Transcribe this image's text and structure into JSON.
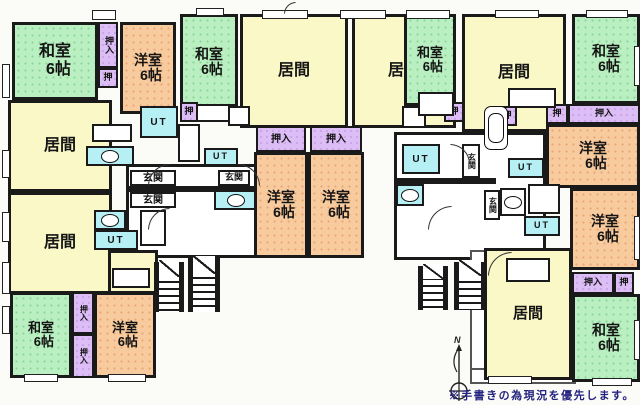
{
  "note": "※手書きの為現況を優先します。",
  "compass_label": "N",
  "colors": {
    "washitsu_green": "#b9efc1",
    "yoshitsu_orange": "#f7cb9e",
    "ima_yellow": "#faf8c6",
    "closet_purple": "#ddbdf5",
    "wet_cyan": "#b6f0f4",
    "wall_black": "#1a1a1a",
    "note_navy": "#23237f"
  },
  "floorplan": {
    "halls": [
      {
        "n": "hallway-left",
        "c": "hall",
        "x": 126,
        "y": 164,
        "w": 134,
        "h": 94
      },
      {
        "n": "hallway-right",
        "c": "hall",
        "x": 394,
        "y": 132,
        "w": 152,
        "h": 128
      },
      {
        "n": "balcony-bottom-right-side",
        "c": "balcony",
        "x": 470,
        "y": 250,
        "w": 16,
        "h": 132
      },
      {
        "n": "balcony-bottom-right-front",
        "c": "balcony",
        "x": 470,
        "y": 368,
        "w": 106,
        "h": 16
      }
    ],
    "walls": [
      {
        "x": 126,
        "y": 186,
        "w": 134,
        "h": 6
      },
      {
        "x": 394,
        "y": 178,
        "w": 102,
        "h": 6
      }
    ],
    "rooms": [
      {
        "n": "washitsu-top-left",
        "t": "和室",
        "s": "6帖",
        "c": "washitsu",
        "x": 12,
        "y": 22,
        "w": 86,
        "h": 78,
        "fs": 16
      },
      {
        "n": "oshiire-top-left",
        "t": "押入",
        "c": "closet",
        "x": 98,
        "y": 22,
        "w": 20,
        "h": 46,
        "fs": 9,
        "v": true
      },
      {
        "n": "oshi-top-left",
        "t": "押",
        "c": "closet",
        "x": 98,
        "y": 68,
        "w": 20,
        "h": 20,
        "fs": 9
      },
      {
        "n": "yoshitsu-top-left",
        "t": "洋室",
        "s": "6帖",
        "c": "yoshitsu",
        "x": 120,
        "y": 22,
        "w": 56,
        "h": 92,
        "fs": 14
      },
      {
        "n": "washitsu-unit-b",
        "t": "和室",
        "s": "6帖",
        "c": "washitsu",
        "x": 180,
        "y": 14,
        "w": 58,
        "h": 96,
        "fs": 14
      },
      {
        "n": "ima-left-upper",
        "t": "居間",
        "c": "ima",
        "x": 8,
        "y": 100,
        "w": 104,
        "h": 92,
        "fs": 16
      },
      {
        "n": "ima-left-lower",
        "t": "居間",
        "c": "ima",
        "x": 8,
        "y": 192,
        "w": 104,
        "h": 102,
        "fs": 16
      },
      {
        "n": "ima-left-lower-ext",
        "t": "",
        "c": "ima",
        "x": 108,
        "y": 250,
        "w": 50,
        "h": 44
      },
      {
        "n": "ut-unit-a",
        "t": "UT",
        "c": "wet",
        "x": 140,
        "y": 106,
        "w": 38,
        "h": 32,
        "fs": 10
      },
      {
        "n": "oshi-unit-a",
        "t": "押",
        "c": "closet",
        "x": 180,
        "y": 102,
        "w": 18,
        "h": 20,
        "fs": 9
      },
      {
        "n": "toilet-unit-a",
        "t": "",
        "c": "wet toilet",
        "x": 86,
        "y": 146,
        "w": 48,
        "h": 20
      },
      {
        "n": "genkan-unit-a",
        "t": "玄関",
        "c": "plain",
        "x": 130,
        "y": 170,
        "w": 46,
        "h": 16,
        "fs": 10
      },
      {
        "n": "genkan-unit-f",
        "t": "玄関",
        "c": "plain",
        "x": 130,
        "y": 192,
        "w": 46,
        "h": 16,
        "fs": 10
      },
      {
        "n": "ut-unit-b",
        "t": "UT",
        "c": "wet",
        "x": 204,
        "y": 148,
        "w": 34,
        "h": 18,
        "fs": 9
      },
      {
        "n": "genkan-unit-b",
        "t": "玄関",
        "c": "plain",
        "x": 218,
        "y": 170,
        "w": 32,
        "h": 16,
        "fs": 9
      },
      {
        "n": "toilet-unit-b",
        "t": "",
        "c": "wet toilet",
        "x": 214,
        "y": 190,
        "w": 44,
        "h": 20
      },
      {
        "n": "toilet-unit-f",
        "t": "",
        "c": "wet toilet",
        "x": 94,
        "y": 210,
        "w": 32,
        "h": 20
      },
      {
        "n": "ut-unit-f",
        "t": "UT",
        "c": "wet",
        "x": 94,
        "y": 230,
        "w": 44,
        "h": 20,
        "fs": 10
      },
      {
        "n": "ima-unit-b",
        "t": "居間",
        "c": "ima",
        "x": 240,
        "y": 14,
        "w": 108,
        "h": 114,
        "fs": 16
      },
      {
        "n": "ima-unit-c",
        "t": "居間",
        "c": "ima",
        "x": 352,
        "y": 14,
        "w": 104,
        "h": 114,
        "fs": 16
      },
      {
        "n": "oshiire-unit-b",
        "t": "押入",
        "c": "closet",
        "x": 256,
        "y": 126,
        "w": 50,
        "h": 26,
        "fs": 10
      },
      {
        "n": "oshiire-unit-c",
        "t": "押入",
        "c": "closet",
        "x": 310,
        "y": 126,
        "w": 52,
        "h": 26,
        "fs": 10
      },
      {
        "n": "yoshitsu-unit-b",
        "t": "洋室",
        "s": "6帖",
        "c": "yoshitsu",
        "x": 254,
        "y": 152,
        "w": 54,
        "h": 106,
        "fs": 14
      },
      {
        "n": "yoshitsu-unit-c",
        "t": "洋室",
        "s": "6帖",
        "c": "yoshitsu",
        "x": 308,
        "y": 152,
        "w": 56,
        "h": 106,
        "fs": 14
      },
      {
        "n": "washitsu-unit-d",
        "t": "和室",
        "s": "6帖",
        "c": "washitsu",
        "x": 404,
        "y": 14,
        "w": 52,
        "h": 92,
        "fs": 13
      },
      {
        "n": "ima-unit-d",
        "t": "居間",
        "c": "ima",
        "x": 462,
        "y": 14,
        "w": 104,
        "h": 118,
        "fs": 16
      },
      {
        "n": "washitsu-top-right",
        "t": "和室",
        "s": "6帖",
        "c": "washitsu",
        "x": 572,
        "y": 14,
        "w": 68,
        "h": 90,
        "fs": 14
      },
      {
        "n": "oshi-unit-d",
        "t": "押",
        "c": "closet",
        "x": 444,
        "y": 102,
        "w": 20,
        "h": 20,
        "fs": 9
      },
      {
        "n": "oshi-unit-d2",
        "t": "押",
        "c": "closet",
        "x": 497,
        "y": 106,
        "w": 20,
        "h": 20,
        "fs": 9
      },
      {
        "n": "oshi-unit-e",
        "t": "押",
        "c": "closet",
        "x": 546,
        "y": 104,
        "w": 22,
        "h": 20,
        "fs": 9
      },
      {
        "n": "oshiire-unit-e",
        "t": "押入",
        "c": "closet",
        "x": 568,
        "y": 104,
        "w": 72,
        "h": 20,
        "fs": 9
      },
      {
        "n": "yoshitsu-unit-d",
        "t": "洋室",
        "s": "6帖",
        "c": "yoshitsu",
        "x": 546,
        "y": 124,
        "w": 94,
        "h": 64,
        "fs": 14
      },
      {
        "n": "yoshitsu-unit-e",
        "t": "洋室",
        "s": "6帖",
        "c": "yoshitsu",
        "x": 570,
        "y": 188,
        "w": 70,
        "h": 82,
        "fs": 14
      },
      {
        "n": "ut-unit-d",
        "t": "UT",
        "c": "wet",
        "x": 402,
        "y": 144,
        "w": 38,
        "h": 30,
        "fs": 10
      },
      {
        "n": "genkan-unit-d",
        "t": "玄関",
        "c": "plain",
        "x": 462,
        "y": 144,
        "w": 18,
        "h": 34,
        "fs": 8,
        "v": true
      },
      {
        "n": "toilet-unit-d",
        "t": "",
        "c": "wet toilet",
        "x": 396,
        "y": 184,
        "w": 28,
        "h": 22
      },
      {
        "n": "bath-unit-e",
        "t": "",
        "c": "wet tub",
        "x": 484,
        "y": 106,
        "w": 24,
        "h": 44
      },
      {
        "n": "ut-unit-e",
        "t": "UT",
        "c": "wet",
        "x": 508,
        "y": 158,
        "w": 36,
        "h": 20,
        "fs": 9
      },
      {
        "n": "genkan-unit-e",
        "t": "玄関",
        "c": "plain",
        "x": 484,
        "y": 190,
        "w": 16,
        "h": 30,
        "fs": 8,
        "v": true
      },
      {
        "n": "toilet-unit-e",
        "t": "",
        "c": "plain toilet",
        "x": 500,
        "y": 188,
        "w": 26,
        "h": 28
      },
      {
        "n": "ut-unit-e2",
        "t": "UT",
        "c": "wet",
        "x": 524,
        "y": 216,
        "w": 36,
        "h": 20,
        "fs": 9
      },
      {
        "n": "washitsu-bottom-left",
        "t": "和室",
        "s": "6帖",
        "c": "washitsu",
        "x": 10,
        "y": 292,
        "w": 62,
        "h": 86,
        "fs": 13
      },
      {
        "n": "oshiire-bottom-left-1",
        "t": "押入",
        "c": "closet",
        "x": 72,
        "y": 292,
        "w": 22,
        "h": 42,
        "fs": 8,
        "v": true
      },
      {
        "n": "oshiire-bottom-left-2",
        "t": "押入",
        "c": "closet",
        "x": 72,
        "y": 334,
        "w": 22,
        "h": 44,
        "fs": 8,
        "v": true
      },
      {
        "n": "yoshitsu-bottom-left",
        "t": "洋室",
        "s": "6帖",
        "c": "yoshitsu",
        "x": 94,
        "y": 292,
        "w": 62,
        "h": 86,
        "fs": 13
      },
      {
        "n": "ima-bottom-right",
        "t": "居間",
        "c": "ima",
        "x": 484,
        "y": 248,
        "w": 88,
        "h": 132,
        "fs": 15
      },
      {
        "n": "oshiire-bottom-right",
        "t": "押入",
        "c": "closet",
        "x": 572,
        "y": 272,
        "w": 42,
        "h": 22,
        "fs": 9
      },
      {
        "n": "oshi-bottom-right",
        "t": "押",
        "c": "closet",
        "x": 614,
        "y": 272,
        "w": 20,
        "h": 22,
        "fs": 9
      },
      {
        "n": "washitsu-bottom-right",
        "t": "和室",
        "s": "6帖",
        "c": "washitsu",
        "x": 572,
        "y": 294,
        "w": 68,
        "h": 88,
        "fs": 14
      }
    ],
    "fixtures": [
      {
        "n": "counter",
        "x": 92,
        "y": 124,
        "w": 40,
        "h": 18
      },
      {
        "n": "bath",
        "x": 178,
        "y": 124,
        "w": 22,
        "h": 38
      },
      {
        "n": "counter",
        "x": 196,
        "y": 104,
        "w": 42,
        "h": 18
      },
      {
        "n": "bath",
        "x": 140,
        "y": 210,
        "w": 26,
        "h": 36
      },
      {
        "n": "counter",
        "x": 112,
        "y": 268,
        "w": 38,
        "h": 20
      },
      {
        "n": "counter",
        "x": 228,
        "y": 106,
        "w": 22,
        "h": 20
      },
      {
        "n": "counter",
        "x": 402,
        "y": 106,
        "w": 24,
        "h": 22
      },
      {
        "n": "bath",
        "x": 418,
        "y": 92,
        "w": 36,
        "h": 24
      },
      {
        "n": "counter",
        "x": 508,
        "y": 88,
        "w": 48,
        "h": 20
      },
      {
        "n": "bath",
        "x": 528,
        "y": 184,
        "w": 32,
        "h": 30
      },
      {
        "n": "counter",
        "x": 506,
        "y": 258,
        "w": 44,
        "h": 24
      }
    ],
    "windows": [
      {
        "x": 92,
        "y": 10,
        "w": 24,
        "h": 10
      },
      {
        "x": 196,
        "y": 8,
        "w": 28,
        "h": 8
      },
      {
        "x": 262,
        "y": 10,
        "w": 46,
        "h": 9
      },
      {
        "x": 340,
        "y": 10,
        "w": 46,
        "h": 9
      },
      {
        "x": 406,
        "y": 10,
        "w": 44,
        "h": 9
      },
      {
        "x": 495,
        "y": 10,
        "w": 44,
        "h": 8
      },
      {
        "x": 586,
        "y": 10,
        "w": 42,
        "h": 8
      },
      {
        "x": 2,
        "y": 64,
        "w": 8,
        "h": 34
      },
      {
        "x": 2,
        "y": 150,
        "w": 8,
        "h": 28
      },
      {
        "x": 2,
        "y": 212,
        "w": 8,
        "h": 30
      },
      {
        "x": 2,
        "y": 262,
        "w": 8,
        "h": 32
      },
      {
        "x": 2,
        "y": 306,
        "w": 8,
        "h": 28
      },
      {
        "x": 24,
        "y": 374,
        "w": 34,
        "h": 8
      },
      {
        "x": 108,
        "y": 374,
        "w": 38,
        "h": 8
      },
      {
        "x": 488,
        "y": 376,
        "w": 44,
        "h": 8
      },
      {
        "x": 592,
        "y": 378,
        "w": 40,
        "h": 8
      },
      {
        "x": 634,
        "y": 46,
        "w": 6,
        "h": 40
      },
      {
        "x": 634,
        "y": 216,
        "w": 6,
        "h": 44
      },
      {
        "x": 634,
        "y": 320,
        "w": 6,
        "h": 40
      }
    ],
    "stairs": [
      {
        "x": 154,
        "y": 262,
        "w": 30,
        "h": 50
      },
      {
        "x": 188,
        "y": 258,
        "w": 32,
        "h": 54
      },
      {
        "x": 418,
        "y": 266,
        "w": 30,
        "h": 44
      },
      {
        "x": 454,
        "y": 262,
        "w": 32,
        "h": 48
      }
    ],
    "doors": [
      {
        "x": 148,
        "y": 164,
        "r": 22,
        "rot": 0
      },
      {
        "x": 148,
        "y": 208,
        "r": 22,
        "rot": 0
      },
      {
        "x": 238,
        "y": 164,
        "r": 22,
        "rot": 90
      },
      {
        "x": 284,
        "y": 2,
        "r": 12,
        "rot": 0
      },
      {
        "x": 428,
        "y": 206,
        "r": 24,
        "rot": 0
      },
      {
        "x": 450,
        "y": 144,
        "r": 20,
        "rot": 90
      },
      {
        "x": 488,
        "y": 252,
        "r": 24,
        "rot": 0
      }
    ]
  }
}
